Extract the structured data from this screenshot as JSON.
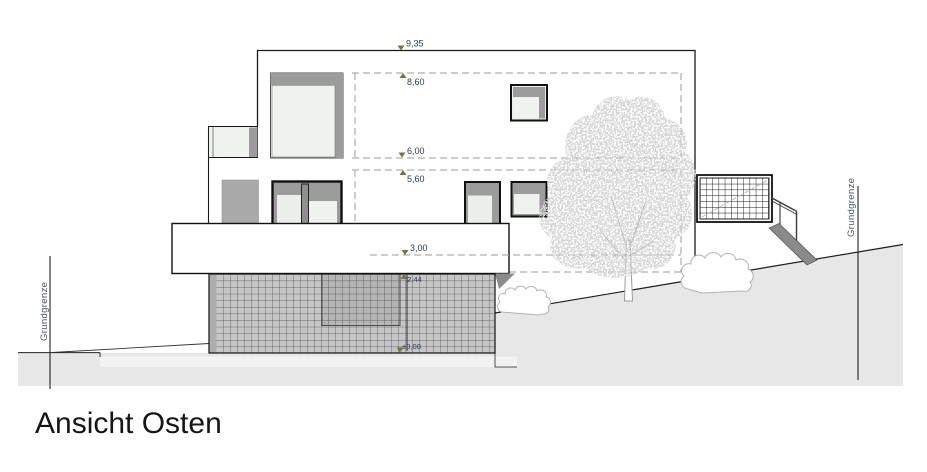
{
  "drawing": {
    "title": "Ansicht Osten",
    "boundary_left": "Grundgrenze",
    "boundary_right": "Grundgrenze",
    "levels": {
      "roof": "9,35",
      "attic": "8,60",
      "upper_floor": "6,00",
      "upper_ceiling": "5,60",
      "main_floor": "3,00",
      "basement_top": "2,44",
      "ground": "±0,00"
    }
  }
}
